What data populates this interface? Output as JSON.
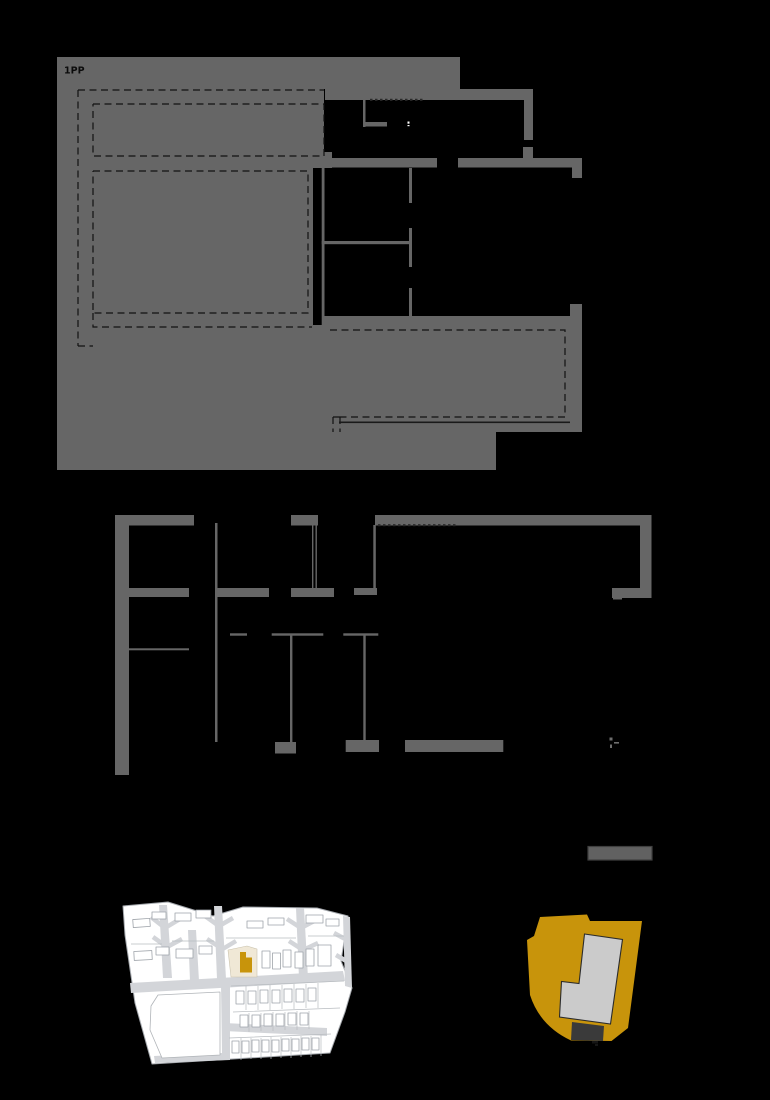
{
  "page": {
    "background": "#000000",
    "width": 770,
    "height": 1100
  },
  "top_plan": {
    "label": "1PP",
    "fill": "#666666",
    "dash_line": "#121212",
    "dot_line": "#2a2a2a",
    "marker_white": "#ffffff"
  },
  "middle_plan": {
    "fill": "#666666",
    "dot_line": "#2a2a2a",
    "figure_mark": "#6e6e6e"
  },
  "scale_bar": {
    "fill": "#616161",
    "border": "#3f3f3f"
  },
  "site_plan": {
    "ground": "#ffffff",
    "road": "#d3d5d9",
    "outline": "#a5a9ae",
    "parcel_line": "#b8bcc0",
    "highlight_plot": "#f0e8d6",
    "highlight_plot_outline": "#c9c2ae",
    "highlight_building": "#c8940b"
  },
  "lot_plan": {
    "lot": "#c8940b",
    "building": "#cbcbcb",
    "building_outline": "#2b2b2b",
    "garage": "#3a3a3a",
    "entry_mark": "#161616"
  }
}
